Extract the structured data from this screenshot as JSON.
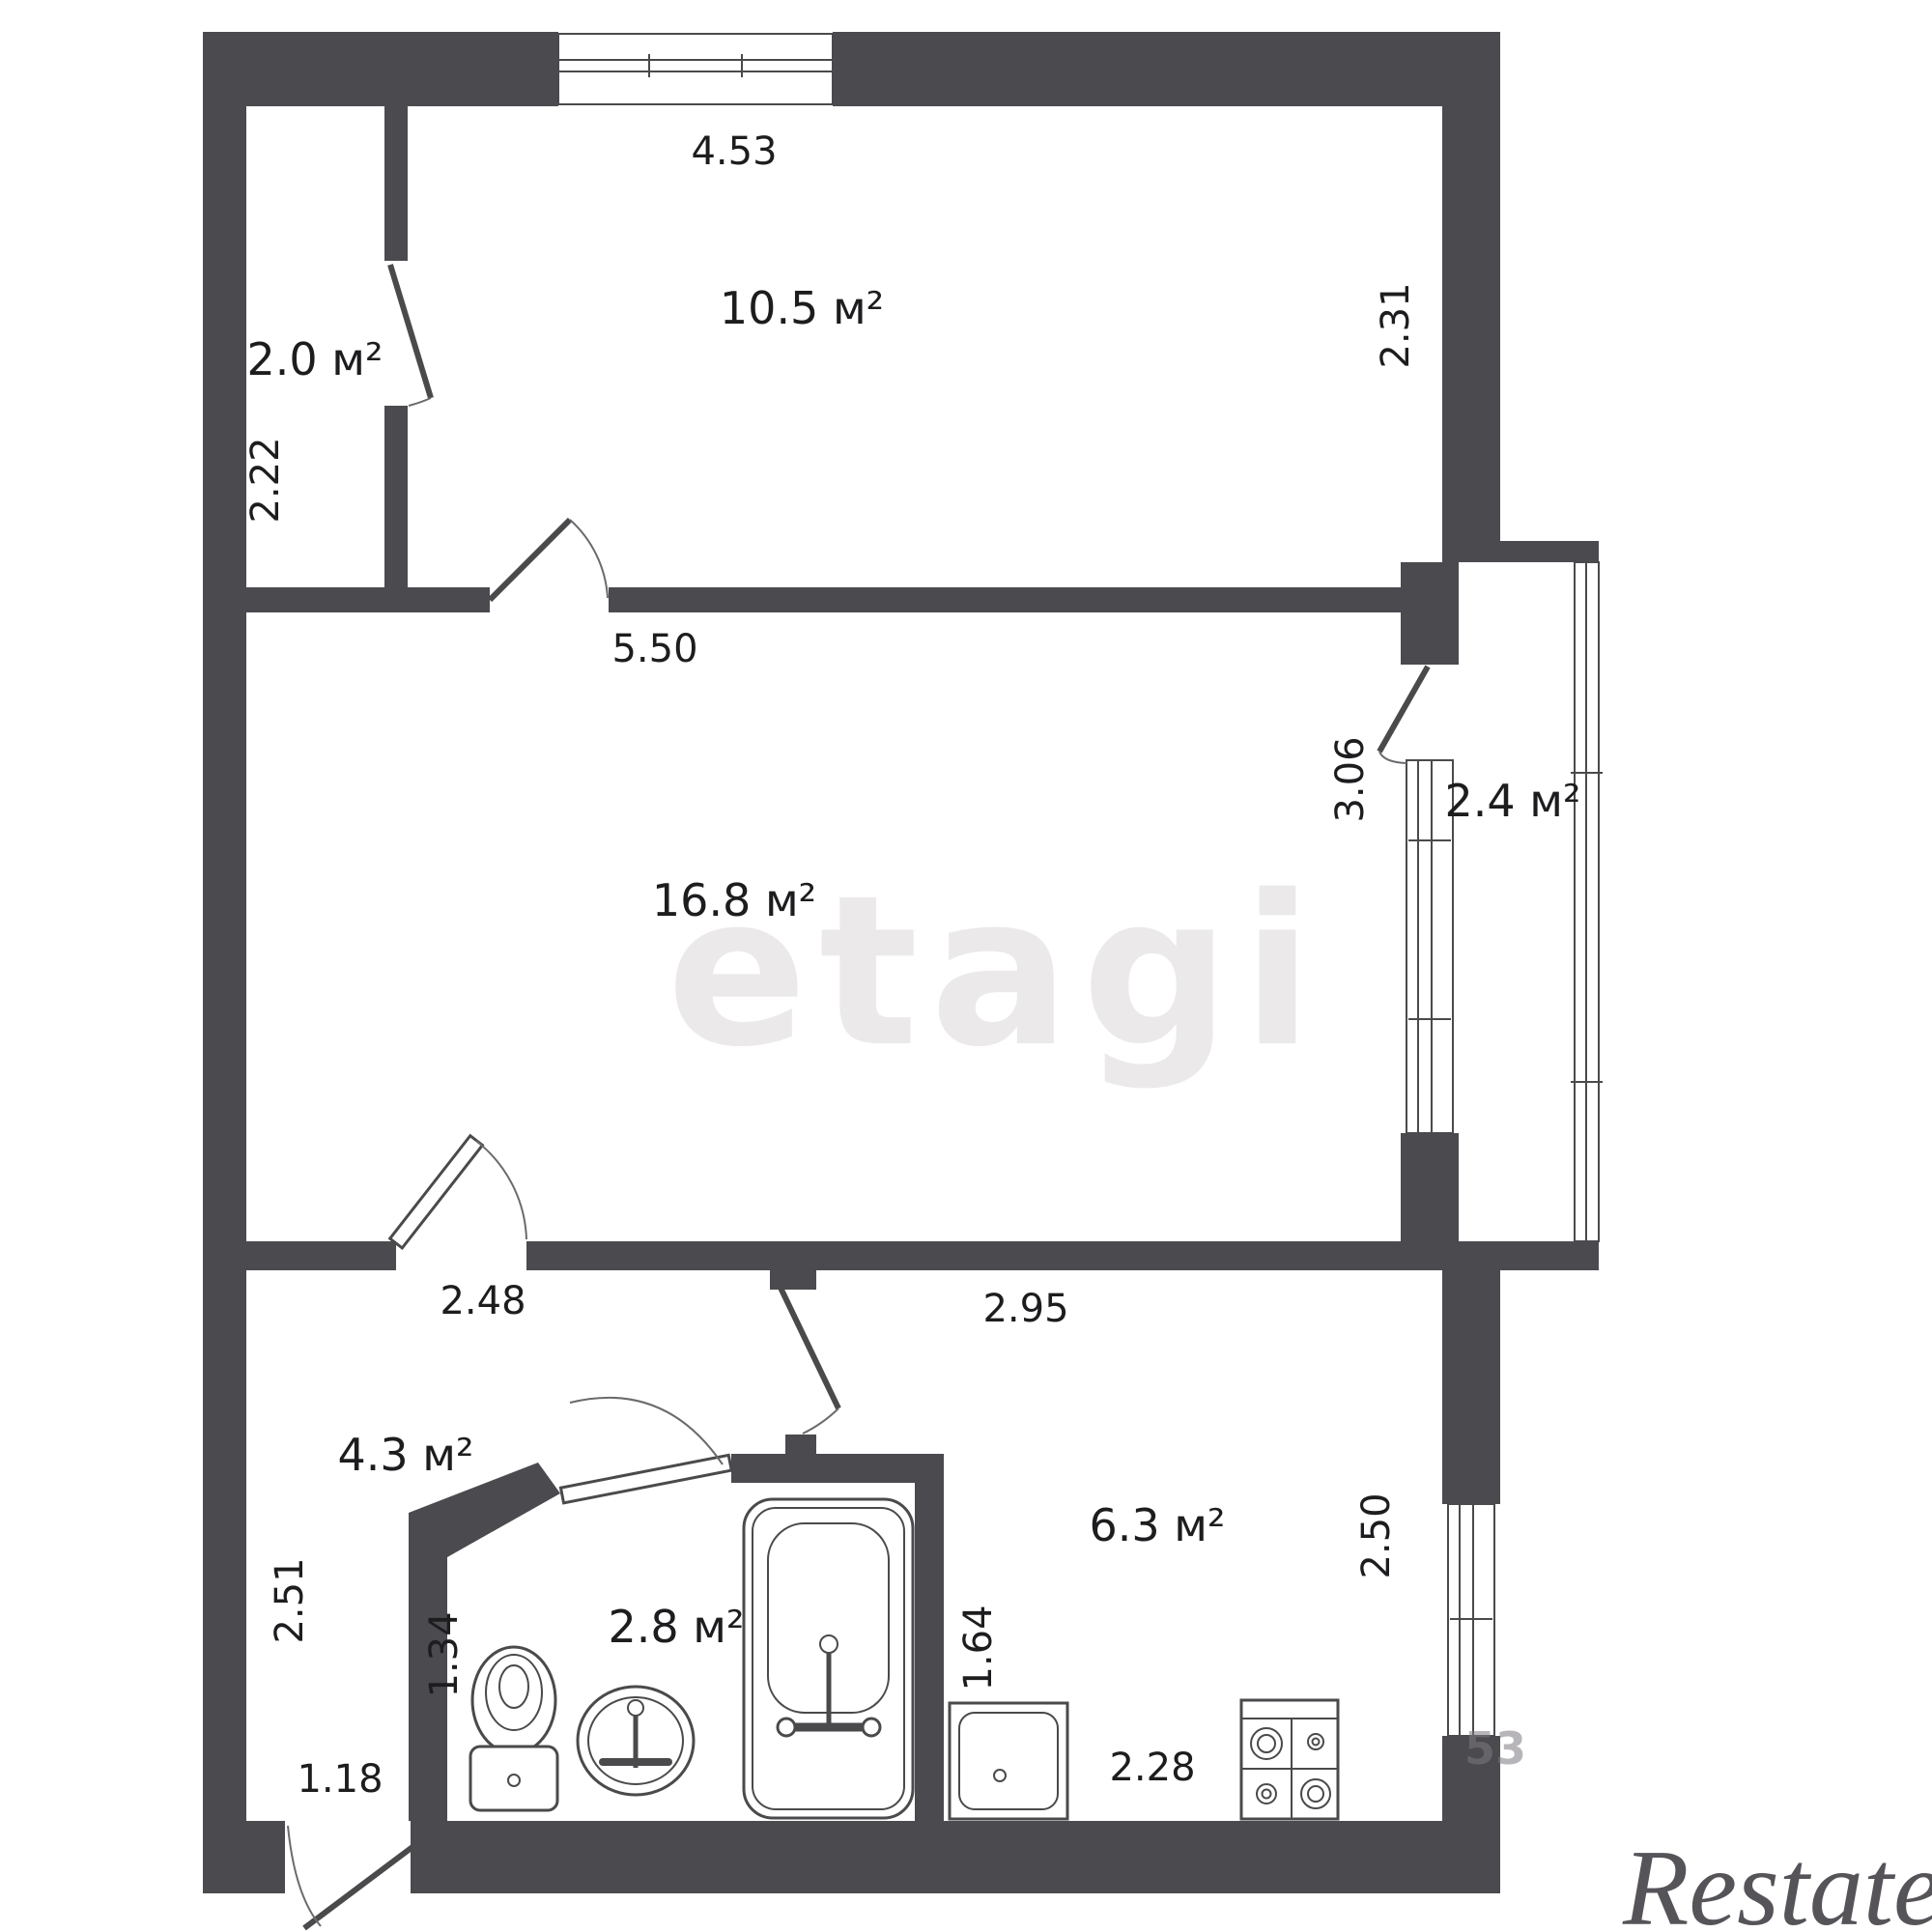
{
  "plan": {
    "type": "apartment-floor-plan",
    "units": "м²"
  },
  "rooms": {
    "closet": {
      "area": "2.0 м²"
    },
    "bedroom": {
      "area": "10.5 м²"
    },
    "living": {
      "area": "16.8 м²"
    },
    "hall": {
      "area": "4.3 м²"
    },
    "bathroom": {
      "area": "2.8 м²"
    },
    "kitchen": {
      "area": "6.3 м²"
    },
    "balcony": {
      "area": "2.4 м²"
    }
  },
  "dimensions": {
    "top_width": "4.53",
    "closet_height": "2.22",
    "bedroom_right": "2.31",
    "living_width": "5.50",
    "living_right": "3.06",
    "hall_width": "2.48",
    "kitchen_top_width": "2.95",
    "hall_left_height": "2.51",
    "hall_inner_height": "1.34",
    "entrance_width": "1.18",
    "kitchen_left_height": "1.64",
    "kitchen_bottom_width": "2.28",
    "kitchen_right_height": "2.50"
  },
  "watermarks": {
    "center": "etagi",
    "corner": "Restate",
    "stray_digits": "53"
  },
  "colors": {
    "wall": "#4b4a4e",
    "line": "#4a4a4c",
    "text": "#1d1c1f",
    "watermark_center": "#ebe9ea",
    "watermark_corner": "#565359",
    "background": "#ffffff"
  }
}
